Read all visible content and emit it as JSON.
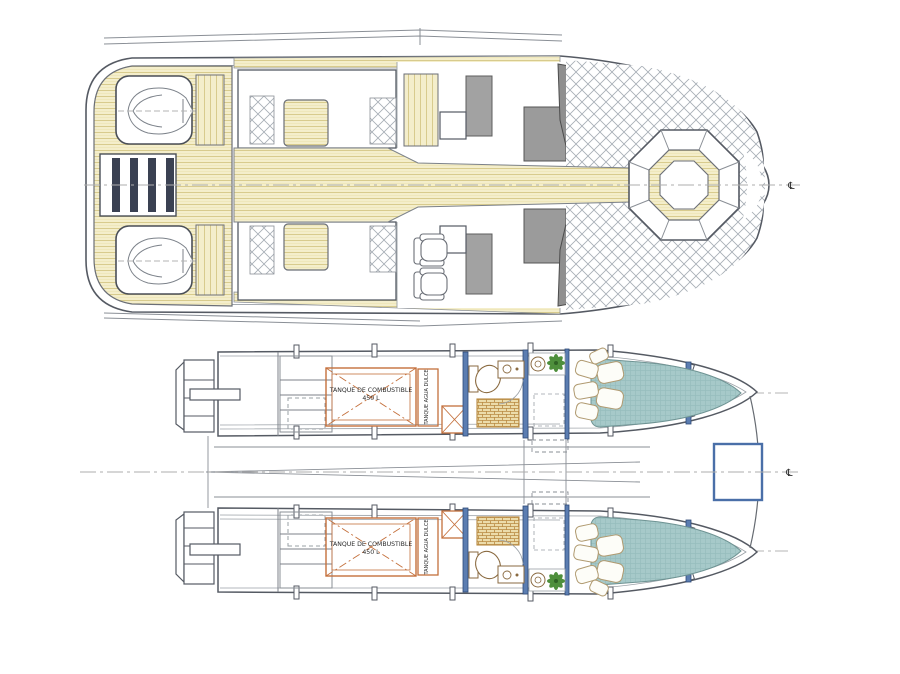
{
  "upper_plan": {
    "centerline_symbol": "℄"
  },
  "lower_plan": {
    "centerline_symbol": "℄",
    "port_hull": {
      "fuel_tank_line1": "TANQUE DE COMBUSTIBLE",
      "fuel_tank_line2": "450 L",
      "water_tank_label": "TANQUE AGUA DULCE"
    },
    "starboard_hull": {
      "fuel_tank_line1": "TANQUE DE COMBUSTIBLE",
      "fuel_tank_line2": "450 L",
      "water_tank_label": "TANQUE AGUA DULCE"
    }
  },
  "colors": {
    "outline": "#555a63",
    "teak": "#f4eecb",
    "teak_line": "#d8cb8d",
    "crosshatch": "#a6adb5",
    "furniture_gray": "#a2a2a2",
    "steps_navy": "#3a4152",
    "tank_orange": "#c4703c",
    "bulkhead_blue": "#5b7db1",
    "bed_teal": "#a6c9c9",
    "plant_green": "#4e8f3c",
    "shower_tan": "#b98a42",
    "centerline_gray": "#adadad"
  }
}
